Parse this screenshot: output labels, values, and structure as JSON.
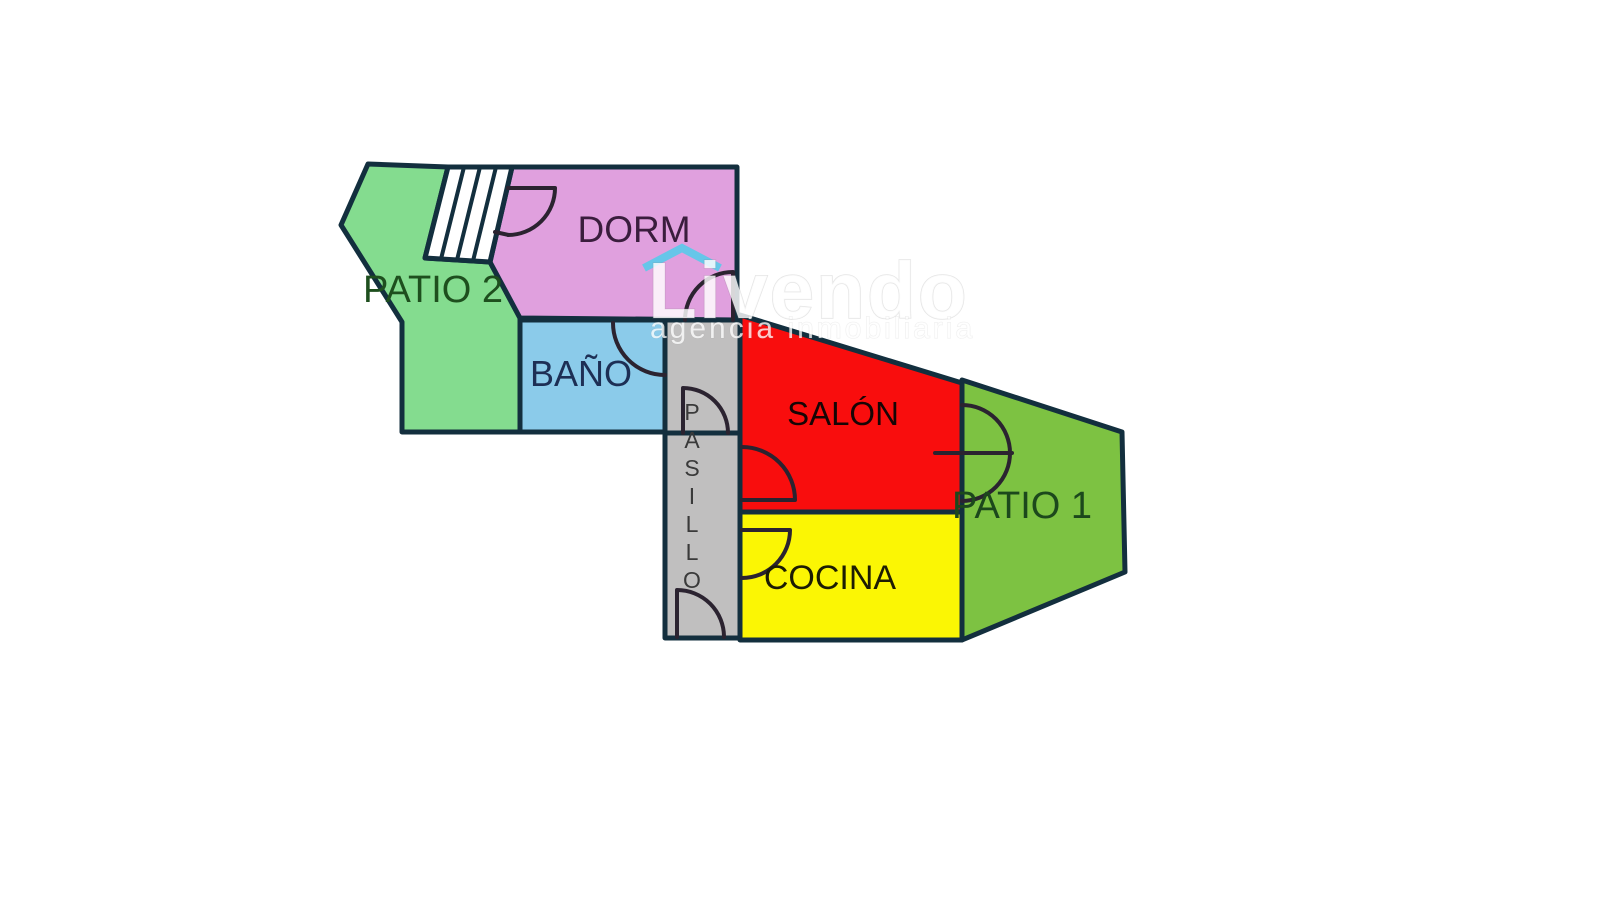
{
  "plan": {
    "type": "apartment-floor-plan",
    "rooms": {
      "patio2": {
        "label": "PATIO 2",
        "color": "#84DC8F",
        "label_color": "#1E4F1E"
      },
      "stairs": {
        "color": "#FFFFFF"
      },
      "dorm": {
        "label": "DORM",
        "color": "#E0A0DE",
        "label_color": "#3A1D3D"
      },
      "bano": {
        "label": "BAÑO",
        "color": "#8BCBEA",
        "label_color": "#1D2F55"
      },
      "pasillo": {
        "label": "PASILLO",
        "letters": [
          "P",
          "A",
          "S",
          "I",
          "L",
          "L",
          "O"
        ],
        "color": "#C0BFBF",
        "label_color": "#3A3A3A"
      },
      "salon": {
        "label": "SALÓN",
        "color": "#F90D0D",
        "label_color": "#170505"
      },
      "cocina": {
        "label": "COCINA",
        "color": "#FBF604",
        "label_color": "#1C1C03"
      },
      "patio1": {
        "label": "PATIO 1",
        "color": "#7DC242",
        "label_color": "#1C481C"
      }
    },
    "outline_color": "#132F3E",
    "door_color": "#2B2330"
  },
  "watermark": {
    "brand": "Livendo",
    "tagline": "agencia inmobiliaria",
    "roof_color": "#5BC9E9",
    "text_color": "#FFFFFF"
  }
}
